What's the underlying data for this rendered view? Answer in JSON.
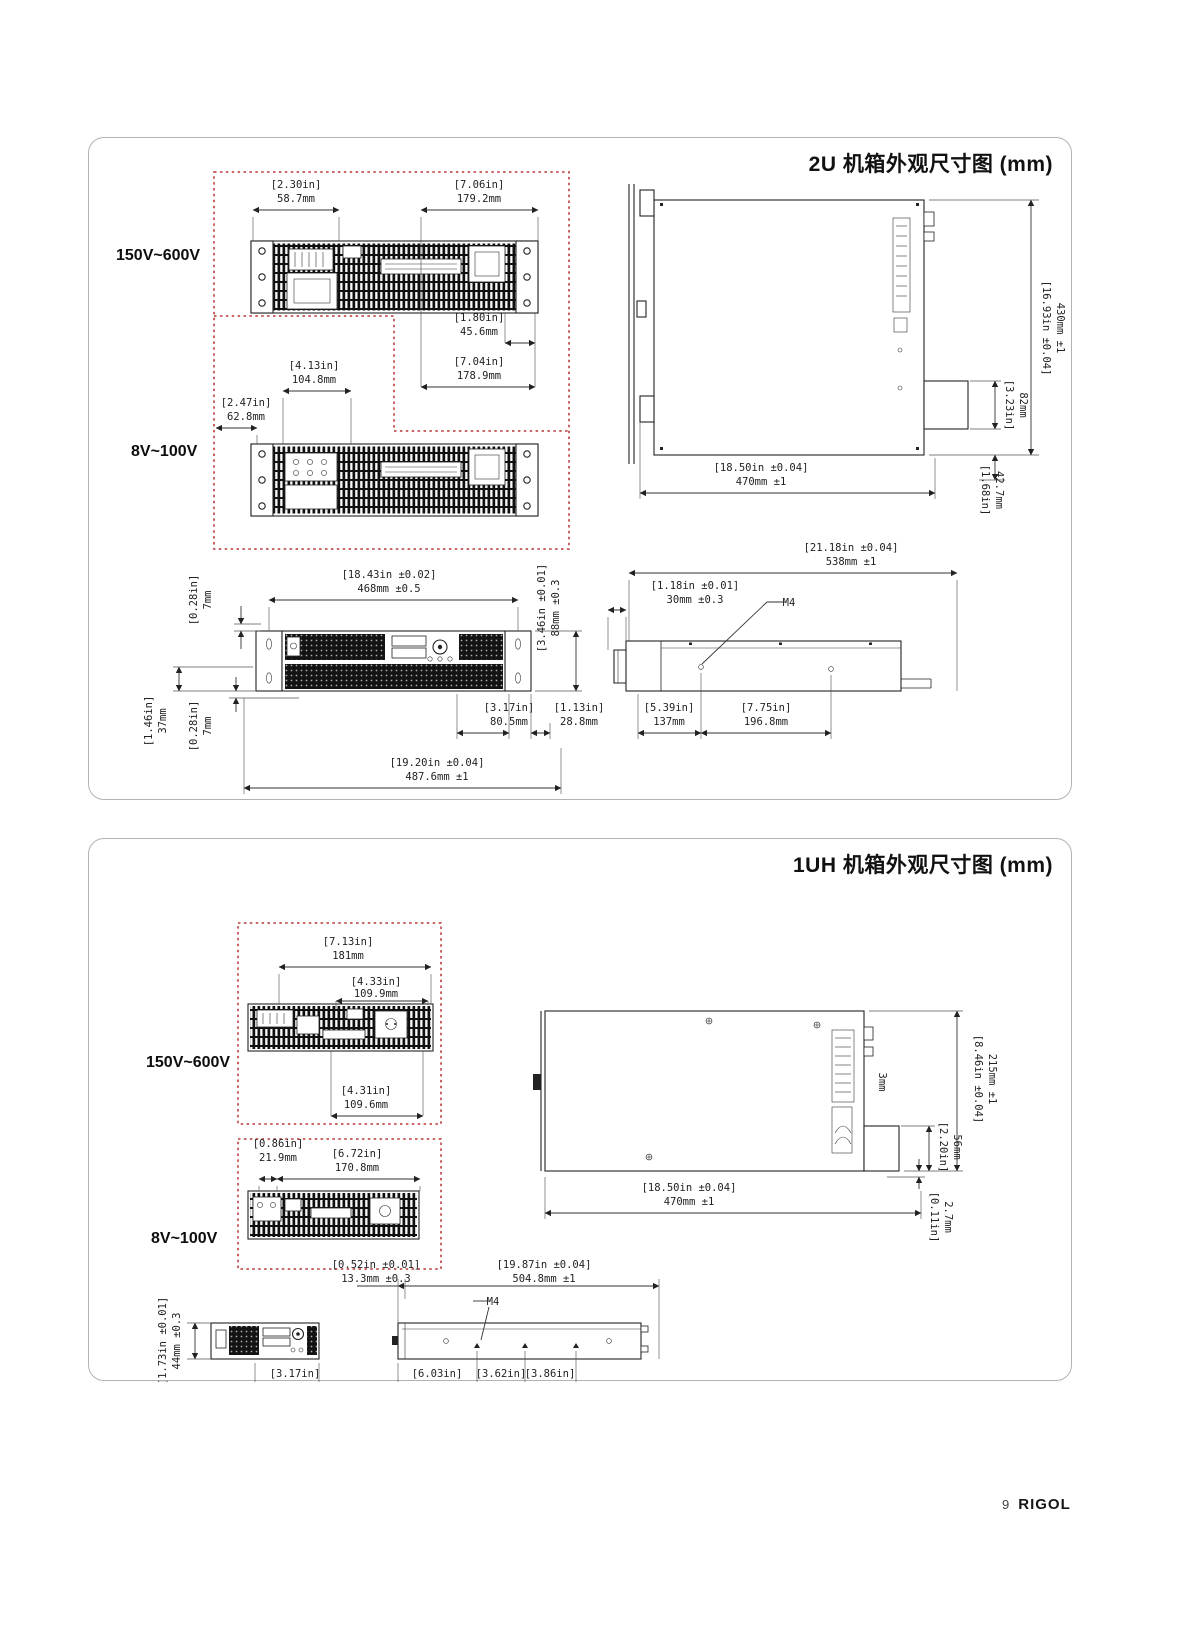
{
  "page": {
    "footer": {
      "page_number": "9",
      "brand": "RIGOL"
    }
  },
  "panel_2u": {
    "title": "2U 机箱外观尺寸图 (mm)",
    "voltage_high": "150V~600V",
    "voltage_low": "8V~100V",
    "dims": {
      "rear_top_left": {
        "in": "[2.30in]",
        "mm": "58.7mm"
      },
      "rear_top_right": {
        "in": "[7.06in]",
        "mm": "179.2mm"
      },
      "rear_sub1": {
        "in": "[1.80in]",
        "mm": "45.6mm"
      },
      "rear_sub2": {
        "in": "[7.04in]",
        "mm": "178.9mm"
      },
      "rear2_top": {
        "in": "[4.13in]",
        "mm": "104.8mm"
      },
      "rear2_left": {
        "in": "[2.47in]",
        "mm": "62.8mm"
      },
      "top_height": {
        "in": "[16.93in ±0.04]",
        "mm": "430mm ±1"
      },
      "top_step": {
        "in": "[3.23in]",
        "mm": "82mm"
      },
      "top_foot": {
        "in": "[1.68in]",
        "mm": "42.7mm"
      },
      "top_width": {
        "in": "[18.50in ±0.04]",
        "mm": "470mm ±1"
      },
      "front_width": {
        "in": "[18.43in ±0.02]",
        "mm": "468mm ±0.5"
      },
      "front_ear_top": {
        "in": "[0.28in]",
        "mm": "7mm"
      },
      "front_half": {
        "in": "[1.46in]",
        "mm": "37mm"
      },
      "front_ear_bottom": {
        "in": "[0.28in]",
        "mm": "7mm"
      },
      "front_height": {
        "in": "[3.46in ±0.01]",
        "mm": "88mm ±0.3"
      },
      "front_lcd": {
        "in": "[3.17in]",
        "mm": "80.5mm"
      },
      "front_right": {
        "in": "[1.13in]",
        "mm": "28.8mm"
      },
      "front_total": {
        "in": "[19.20in ±0.04]",
        "mm": "487.6mm ±1"
      },
      "side_depth": {
        "in": "[21.18in ±0.04]",
        "mm": "538mm ±1"
      },
      "side_handle": {
        "in": "[1.18in ±0.01]",
        "mm": "30mm ±0.3"
      },
      "side_hole1": {
        "in": "[5.39in]",
        "mm": "137mm"
      },
      "side_hole2": {
        "in": "[7.75in]",
        "mm": "196.8mm"
      },
      "screw": "M4"
    }
  },
  "panel_1uh": {
    "title": "1UH 机箱外观尺寸图 (mm)",
    "voltage_high": "150V~600V",
    "voltage_low": "8V~100V",
    "dims": {
      "rear_width": {
        "in": "[7.13in]",
        "mm": "181mm"
      },
      "rear_conn_top": {
        "in": "[4.33in]",
        "mm": "109.9mm"
      },
      "rear_conn_bottom": {
        "in": "[4.31in]",
        "mm": "109.6mm"
      },
      "rear2_left": {
        "in": "[0.86in]",
        "mm": "21.9mm"
      },
      "rear2_width": {
        "in": "[6.72in]",
        "mm": "170.8mm"
      },
      "top_height": {
        "in": "[8.46in ±0.04]",
        "mm": "215mm ±1"
      },
      "top_gap": "3mm",
      "top_step": {
        "in": "[2.20in]",
        "mm": "56mm"
      },
      "top_foot": {
        "in": "[0.11in]",
        "mm": "2.7mm"
      },
      "top_width": {
        "in": "[18.50in ±0.04]",
        "mm": "470mm ±1"
      },
      "front_height": {
        "in": "[1.73in ±0.01]",
        "mm": "44mm ±0.3"
      },
      "front_lcd": {
        "in": "[3.17in]",
        "mm": "80.5mm"
      },
      "side_front": {
        "in": "[0.52in ±0.01]",
        "mm": "13.3mm ±0.3"
      },
      "side_depth": {
        "in": "[19.87in ±0.04]",
        "mm": "504.8mm ±1"
      },
      "side_hole1": {
        "in": "[6.03in]",
        "mm": "153.2mm"
      },
      "side_hole2": {
        "in": "[3.62in]",
        "mm": "92mm"
      },
      "side_hole3": {
        "in": "[3.86in]",
        "mm": "98mm"
      },
      "screw": "M4"
    }
  }
}
